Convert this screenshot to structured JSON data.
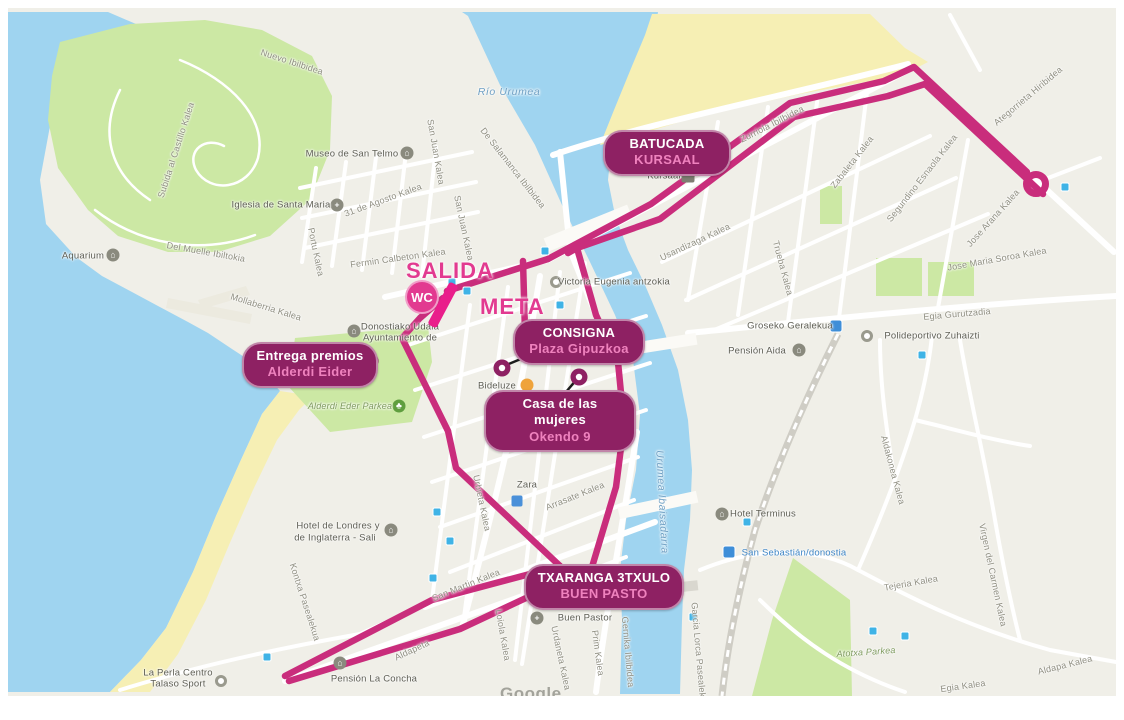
{
  "watermark": "Google",
  "start_finish": {
    "salida": "SALIDA",
    "meta": "META",
    "wc": "WC"
  },
  "pills": [
    {
      "id": "batucada",
      "line1": "BATUCADA",
      "line2": "KURSAAL"
    },
    {
      "id": "consigna",
      "line1": "CONSIGNA",
      "line2": "Plaza Gipuzkoa"
    },
    {
      "id": "casa",
      "line1": "Casa de las mujeres",
      "line2": "Okendo 9"
    },
    {
      "id": "premios",
      "line1": "Entrega premios",
      "line2": "Alderdi Eider"
    },
    {
      "id": "txaranga",
      "line1": "TXARANGA 3TXULO",
      "line2": "BUEN PASTO"
    }
  ],
  "colors": {
    "route": "#c92d7c",
    "start_bar": "#e91e8b",
    "start_text": "#e23a90",
    "pill_bg": "#8e2163",
    "pill_accent": "#ef82be",
    "water": "#9fd4f0",
    "sand": "#f6efb4",
    "park": "#cce8a4",
    "land": "#f0efe8"
  },
  "labels": [
    {
      "t": "Nuevo Ibilbidea",
      "x": 292,
      "y": 62,
      "r": 18,
      "c": "s"
    },
    {
      "t": "Subida al Castillo Kalea",
      "x": 176,
      "y": 150,
      "r": -72,
      "c": "s"
    },
    {
      "t": "Del Muelle Ibiltokia",
      "x": 206,
      "y": 252,
      "r": 10,
      "c": "s"
    },
    {
      "t": "Mollaberria Kalea",
      "x": 266,
      "y": 307,
      "r": 17,
      "c": "s"
    },
    {
      "t": "31 de Agosto Kalea",
      "x": 383,
      "y": 200,
      "r": -20,
      "c": "s"
    },
    {
      "t": "San Juan Kalea",
      "x": 436,
      "y": 152,
      "r": 80,
      "c": "s"
    },
    {
      "t": "San Juan Kalea",
      "x": 464,
      "y": 228,
      "r": 78,
      "c": "s"
    },
    {
      "t": "De Salamanca Ibilbidea",
      "x": 513,
      "y": 168,
      "r": 52,
      "c": "s"
    },
    {
      "t": "Fermin Calbeton Kalea",
      "x": 398,
      "y": 258,
      "r": -8,
      "c": "s"
    },
    {
      "t": "Portu Kalea",
      "x": 316,
      "y": 252,
      "r": 78,
      "c": "s"
    },
    {
      "t": "Zurriola Ibilbidea",
      "x": 772,
      "y": 124,
      "r": -27,
      "c": "s"
    },
    {
      "t": "Usandizaga Kalea",
      "x": 695,
      "y": 242,
      "r": -25,
      "c": "s"
    },
    {
      "t": "Trueba Kalea",
      "x": 783,
      "y": 268,
      "r": 75,
      "c": "s"
    },
    {
      "t": "Zabaleta Kalea",
      "x": 852,
      "y": 162,
      "r": -52,
      "c": "s"
    },
    {
      "t": "Segundino Esnaola Kalea",
      "x": 922,
      "y": 178,
      "r": -52,
      "c": "s"
    },
    {
      "t": "Jose Arana Kalea",
      "x": 993,
      "y": 218,
      "r": -48,
      "c": "s"
    },
    {
      "t": "Jose Maria Soroa Kalea",
      "x": 997,
      "y": 259,
      "r": -10,
      "c": "s"
    },
    {
      "t": "Ategorrieta Hiribidea",
      "x": 1028,
      "y": 96,
      "r": -40,
      "c": "s"
    },
    {
      "t": "Egia Gurutzadia",
      "x": 957,
      "y": 314,
      "r": -5,
      "c": "s"
    },
    {
      "t": "Arrasate Kalea",
      "x": 575,
      "y": 496,
      "r": -22,
      "c": "s"
    },
    {
      "t": "Urbieta Kalea",
      "x": 482,
      "y": 503,
      "r": 78,
      "c": "s"
    },
    {
      "t": "Loiola Kalea",
      "x": 503,
      "y": 635,
      "r": 80,
      "c": "s"
    },
    {
      "t": "Urdaneta Kalea",
      "x": 561,
      "y": 658,
      "r": 78,
      "c": "s"
    },
    {
      "t": "Prim Kalea",
      "x": 598,
      "y": 653,
      "r": 82,
      "c": "s"
    },
    {
      "t": "Gernika Ibilbidea",
      "x": 628,
      "y": 652,
      "r": 85,
      "c": "s"
    },
    {
      "t": "Kontxa Pasealekua",
      "x": 305,
      "y": 602,
      "r": 72,
      "c": "s"
    },
    {
      "t": "San Martin Kalea",
      "x": 466,
      "y": 585,
      "r": -22,
      "c": "s"
    },
    {
      "t": "Aldapeta",
      "x": 412,
      "y": 650,
      "r": -25,
      "c": "s"
    },
    {
      "t": "Tejeria Kalea",
      "x": 911,
      "y": 583,
      "r": -10,
      "c": "s"
    },
    {
      "t": "Egia Kalea",
      "x": 963,
      "y": 686,
      "r": -8,
      "c": "s"
    },
    {
      "t": "Aldapa Kalea",
      "x": 1065,
      "y": 665,
      "r": -14,
      "c": "s"
    },
    {
      "t": "Aldakonea Kalea",
      "x": 893,
      "y": 470,
      "r": 75,
      "c": "s"
    },
    {
      "t": "Virgen del Carmen Kalea",
      "x": 993,
      "y": 575,
      "r": 78,
      "c": "s"
    },
    {
      "t": "Garcia Lorca Pasealekua",
      "x": 699,
      "y": 655,
      "r": 85,
      "c": "s"
    },
    {
      "t": "Río Urumea",
      "x": 509,
      "y": 92,
      "r": 0,
      "c": "w"
    },
    {
      "t": "Urumea Ibaisadarra",
      "x": 662,
      "y": 502,
      "r": 87,
      "c": "w"
    },
    {
      "t": "Alderdi Eder Parkea",
      "x": 350,
      "y": 406,
      "r": 0,
      "c": "a"
    },
    {
      "t": "Atotxa Parkea",
      "x": 866,
      "y": 652,
      "r": -4,
      "c": "a"
    },
    {
      "t": "Museo de San Telmo",
      "x": 352,
      "y": 154,
      "r": 0,
      "c": "p"
    },
    {
      "t": "Iglesia de Santa Maria",
      "x": 281,
      "y": 205,
      "r": 0,
      "c": "p"
    },
    {
      "t": "Aquarium",
      "x": 83,
      "y": 256,
      "r": 0,
      "c": "p"
    },
    {
      "t": "Donostiako Udala",
      "x": 400,
      "y": 327,
      "r": 0,
      "c": "p"
    },
    {
      "t": "Ayuntamiento de",
      "x": 400,
      "y": 338,
      "r": 0,
      "c": "p"
    },
    {
      "t": "Victoria Eugenia antzokia",
      "x": 614,
      "y": 282,
      "r": 0,
      "c": "p"
    },
    {
      "t": "Bideluze",
      "x": 497,
      "y": 386,
      "r": 0,
      "c": "p"
    },
    {
      "t": "Kursaal",
      "x": 664,
      "y": 176,
      "r": 0,
      "c": "p"
    },
    {
      "t": "Groseko Geralekua",
      "x": 790,
      "y": 326,
      "r": 0,
      "c": "p"
    },
    {
      "t": "Pensión Aida",
      "x": 757,
      "y": 351,
      "r": 0,
      "c": "p"
    },
    {
      "t": "Polideportivo Zuhaizti",
      "x": 932,
      "y": 336,
      "r": 0,
      "c": "p"
    },
    {
      "t": "Zara",
      "x": 527,
      "y": 485,
      "r": 0,
      "c": "p"
    },
    {
      "t": "Buen Pastor",
      "x": 585,
      "y": 618,
      "r": 0,
      "c": "p"
    },
    {
      "t": "Hotel de Londres y",
      "x": 338,
      "y": 526,
      "r": 0,
      "c": "p"
    },
    {
      "t": "de Inglaterra - Sali",
      "x": 335,
      "y": 538,
      "r": 0,
      "c": "p"
    },
    {
      "t": "Hotel Terminus",
      "x": 763,
      "y": 514,
      "r": 0,
      "c": "p"
    },
    {
      "t": "San Sebastián/donostia",
      "x": 794,
      "y": 553,
      "r": 0,
      "c": "b"
    },
    {
      "t": "Pensión La Concha",
      "x": 374,
      "y": 679,
      "r": 0,
      "c": "p"
    },
    {
      "t": "La Perla Centro",
      "x": 178,
      "y": 673,
      "r": 0,
      "c": "p"
    },
    {
      "t": "Talaso Sport",
      "x": 178,
      "y": 684,
      "r": 0,
      "c": "p"
    }
  ],
  "icons": [
    {
      "x": 407,
      "y": 153,
      "k": "bld",
      "g": "⌂",
      "n": "museum-icon"
    },
    {
      "x": 337,
      "y": 205,
      "k": "church",
      "g": "+",
      "n": "church-icon"
    },
    {
      "x": 113,
      "y": 255,
      "k": "bld",
      "g": "⌂",
      "n": "aquarium-icon"
    },
    {
      "x": 354,
      "y": 331,
      "k": "bld",
      "g": "⌂",
      "n": "city-hall-icon"
    },
    {
      "x": 556,
      "y": 282,
      "k": "ring",
      "g": "",
      "n": "theater-icon"
    },
    {
      "x": 527,
      "y": 385,
      "k": "cafe",
      "g": "",
      "n": "cafe-icon"
    },
    {
      "x": 688,
      "y": 176,
      "k": "sq",
      "g": "",
      "n": "kursaal-icon"
    },
    {
      "x": 799,
      "y": 350,
      "k": "bld",
      "g": "⌂",
      "n": "pension-icon"
    },
    {
      "x": 867,
      "y": 336,
      "k": "ring",
      "g": "",
      "n": "sports-icon"
    },
    {
      "x": 399,
      "y": 406,
      "k": "tree",
      "g": "♣",
      "n": "park-tree-icon"
    },
    {
      "x": 537,
      "y": 618,
      "k": "church",
      "g": "+",
      "n": "church-icon"
    },
    {
      "x": 391,
      "y": 530,
      "k": "bld",
      "g": "⌂",
      "n": "hotel-icon"
    },
    {
      "x": 722,
      "y": 514,
      "k": "bld",
      "g": "⌂",
      "n": "hotel-icon"
    },
    {
      "x": 340,
      "y": 663,
      "k": "bld",
      "g": "⌂",
      "n": "pension-icon"
    },
    {
      "x": 221,
      "y": 681,
      "k": "ring",
      "g": "",
      "n": "spa-icon"
    },
    {
      "x": 517,
      "y": 501,
      "k": "shop",
      "g": "",
      "n": "shop-icon"
    }
  ],
  "transit": [
    {
      "x": 452,
      "y": 282,
      "train": false
    },
    {
      "x": 467,
      "y": 291,
      "train": false
    },
    {
      "x": 545,
      "y": 251,
      "train": false
    },
    {
      "x": 560,
      "y": 305,
      "train": false
    },
    {
      "x": 590,
      "y": 433,
      "train": false
    },
    {
      "x": 437,
      "y": 512,
      "train": false
    },
    {
      "x": 450,
      "y": 541,
      "train": false
    },
    {
      "x": 433,
      "y": 578,
      "train": false
    },
    {
      "x": 267,
      "y": 657,
      "train": false
    },
    {
      "x": 747,
      "y": 522,
      "train": false
    },
    {
      "x": 1065,
      "y": 187,
      "train": false
    },
    {
      "x": 922,
      "y": 355,
      "train": false
    },
    {
      "x": 693,
      "y": 617,
      "train": false
    },
    {
      "x": 873,
      "y": 631,
      "train": false
    },
    {
      "x": 905,
      "y": 636,
      "train": false
    },
    {
      "x": 836,
      "y": 326,
      "train": true
    },
    {
      "x": 729,
      "y": 552,
      "train": true
    }
  ]
}
